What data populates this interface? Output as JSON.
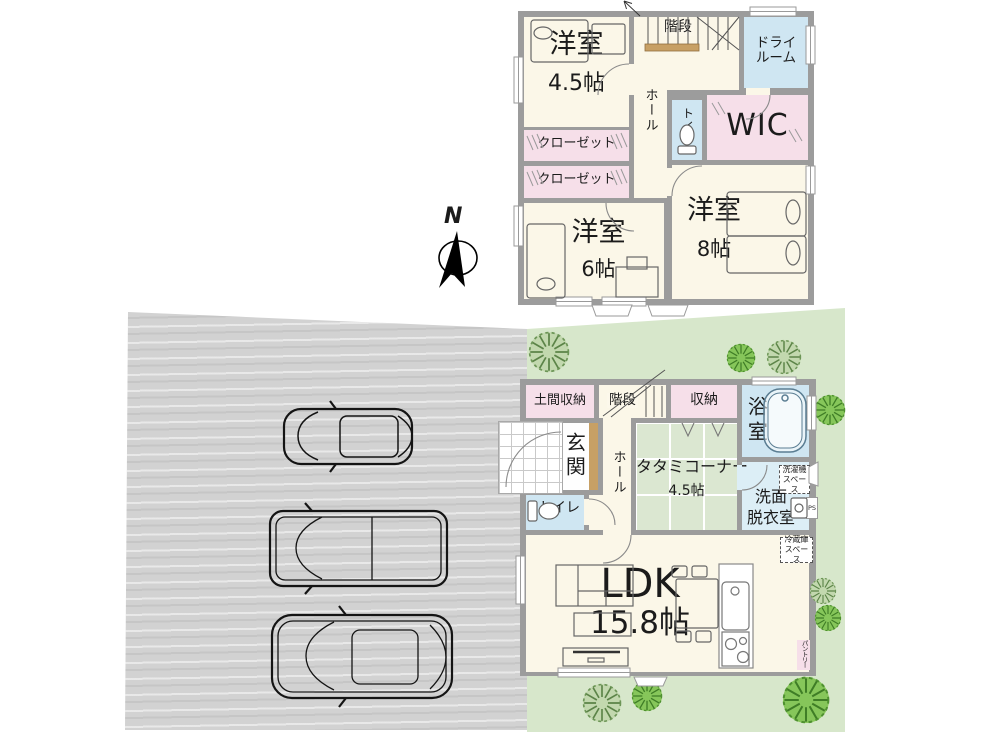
{
  "compass": {
    "north_label": "N"
  },
  "floor2": {
    "room_45": {
      "name": "洋室",
      "area": "4.5帖"
    },
    "closet_a": {
      "name": "クローゼット"
    },
    "closet_b": {
      "name": "クローゼット"
    },
    "room_6": {
      "name": "洋室",
      "area": "6帖"
    },
    "room_8": {
      "name": "洋室",
      "area": "8帖"
    },
    "stairs": {
      "name": "階段"
    },
    "hall": {
      "name": "ホール"
    },
    "toilet": {
      "name": "トイレ"
    },
    "dry_room": {
      "line1": "ドライ",
      "line2": "ルーム"
    },
    "wic": {
      "name": "WIC"
    }
  },
  "floor1": {
    "doma_storage": {
      "name": "土間収納"
    },
    "stairs": {
      "name": "階段"
    },
    "storage": {
      "name": "収納"
    },
    "bath": {
      "name": "浴室"
    },
    "genkan": {
      "name": "玄関"
    },
    "hall": {
      "name": "ホール"
    },
    "tatami_corner": {
      "name": "タタミコーナー",
      "area": "4.5帖"
    },
    "washroom": {
      "line1": "洗面",
      "line2": "脱衣室"
    },
    "washer_space": {
      "line1": "洗濯機",
      "line2": "スペース"
    },
    "pipe_space": {
      "name": "PS"
    },
    "toilet": {
      "name": "トイレ"
    },
    "ldk": {
      "name": "LDK",
      "area": "15.8帖"
    },
    "fridge_space": {
      "line1": "冷蔵庫",
      "line2": "スペース"
    },
    "pantry": {
      "name": "パントリー"
    }
  },
  "colors": {
    "wall": "#9c9c9c",
    "room_cream": "#fbf7e8",
    "accent_pink": "#f6dfe9",
    "accent_blue": "#cfe6f2",
    "accent_blue_light": "#dceef6",
    "tatami_green": "#dbe7d1",
    "lawn_green": "#d7e7cb",
    "driveway_gray": "#d2d2d2",
    "wood_brown": "#c7a065",
    "tree_green": "#76b941"
  }
}
